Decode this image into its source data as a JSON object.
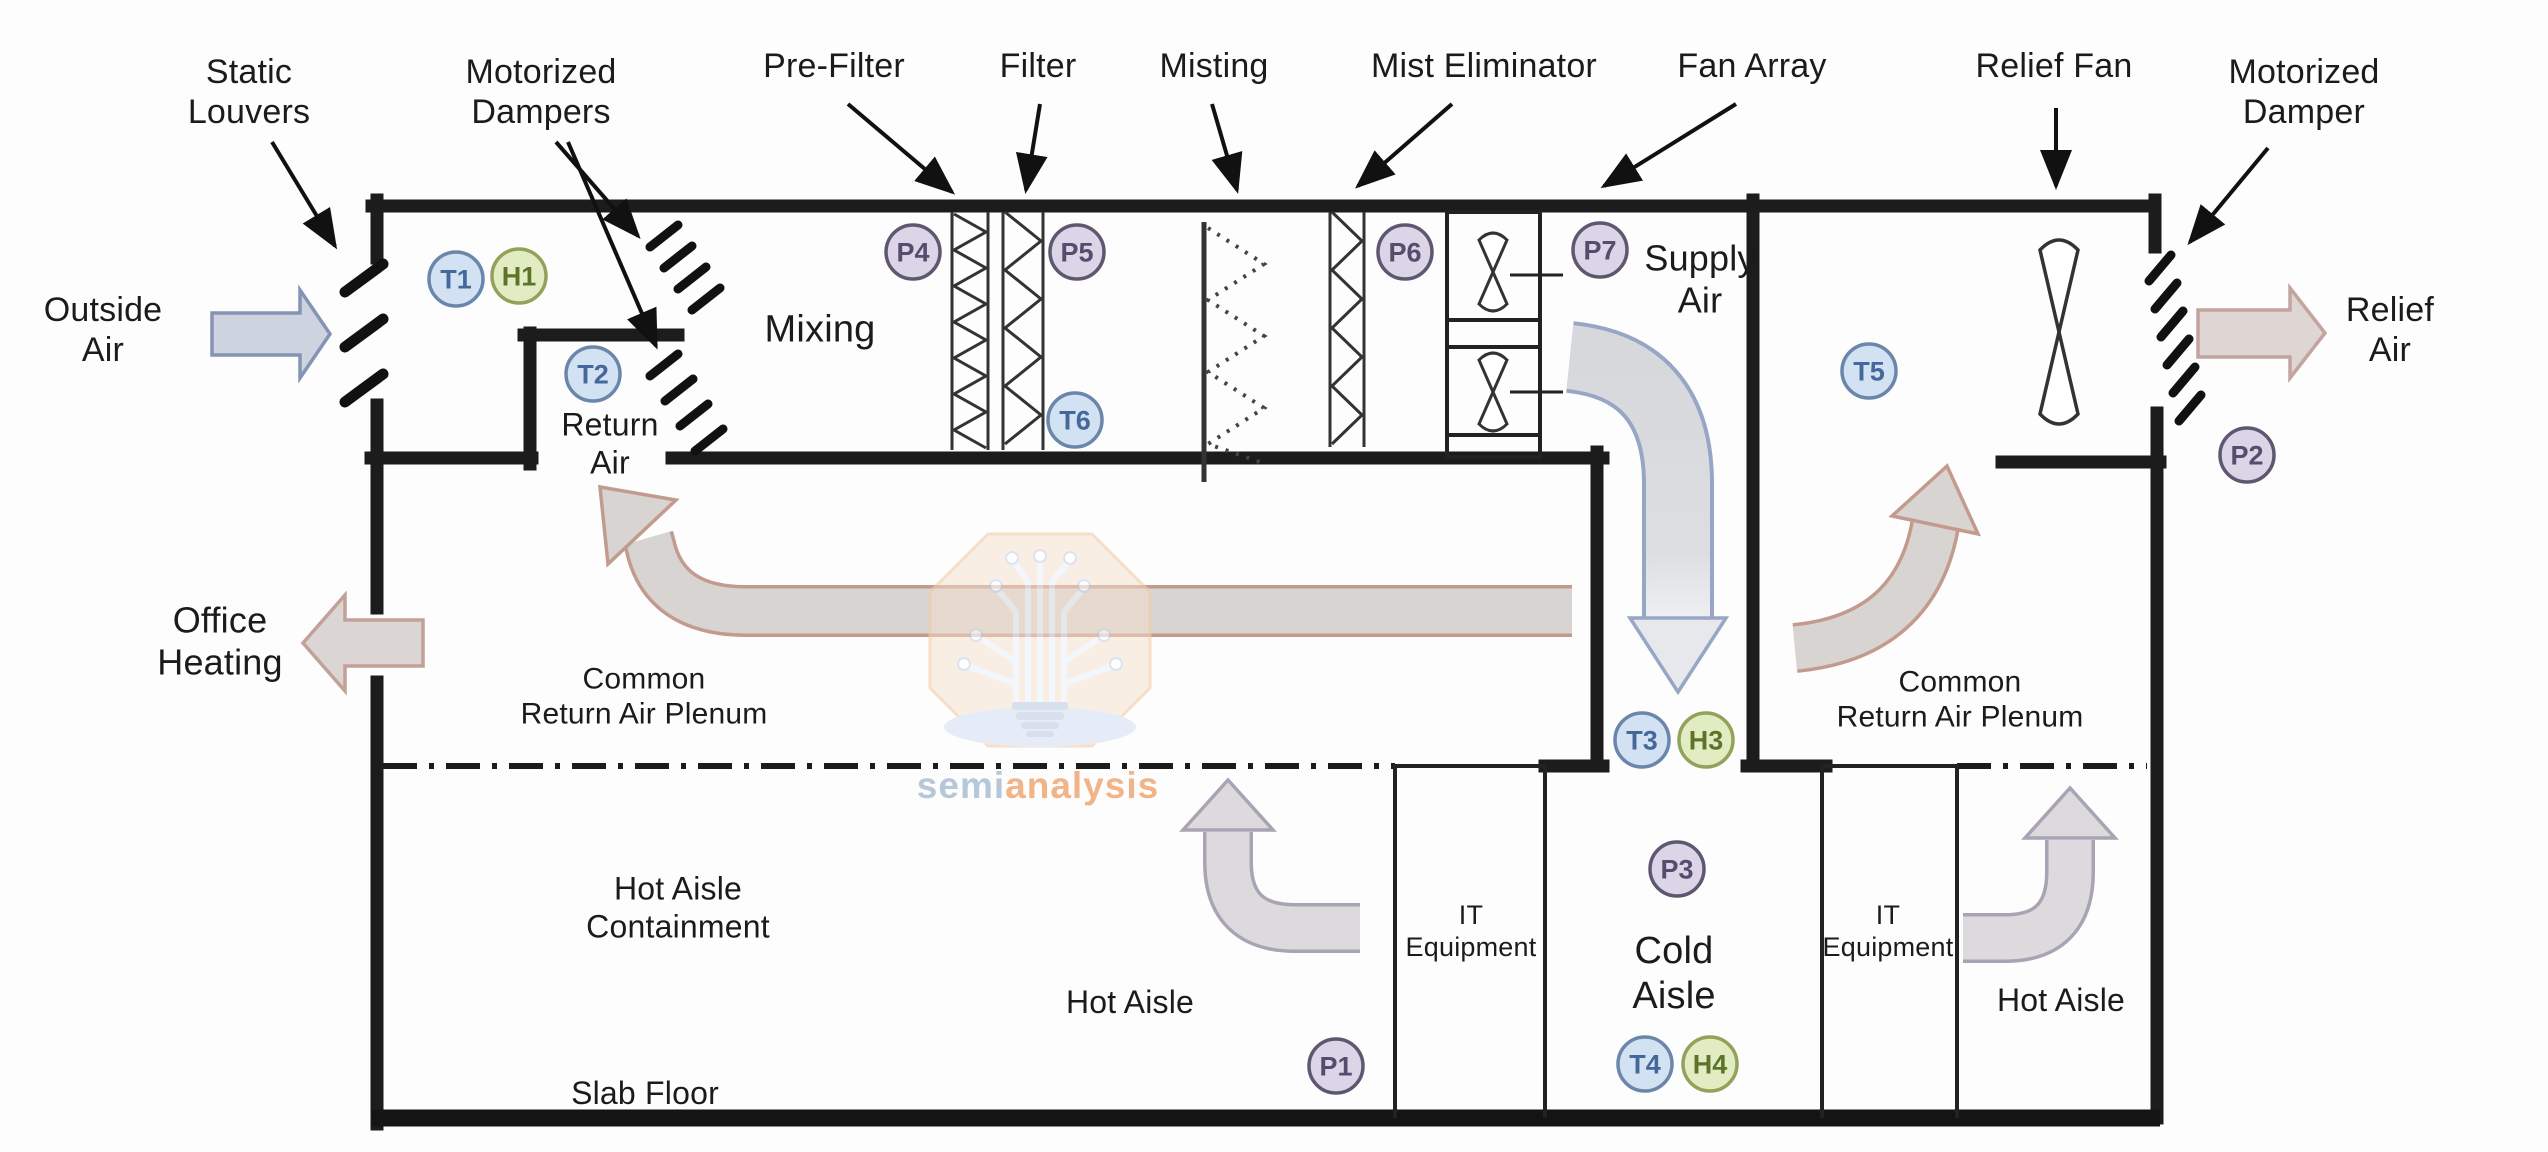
{
  "labels": {
    "static_louvers": "Static\nLouvers",
    "motorized_dampers": "Motorized\nDampers",
    "pre_filter": "Pre-Filter",
    "filter": "Filter",
    "misting": "Misting",
    "mist_eliminator": "Mist Eliminator",
    "fan_array": "Fan Array",
    "relief_fan": "Relief Fan",
    "motorized_damper": "Motorized\nDamper",
    "outside_air": "Outside\nAir",
    "relief_air": "Relief\nAir",
    "office_heating": "Office\nHeating",
    "mixing": "Mixing",
    "return_air": "Return\nAir",
    "supply_air": "Supply\nAir",
    "common_return_air_plenum_left": "Common\nReturn Air Plenum",
    "common_return_air_plenum_right": "Common\nReturn Air Plenum",
    "hot_aisle_containment": "Hot Aisle\nContainment",
    "hot_aisle_left": "Hot Aisle",
    "hot_aisle_right": "Hot Aisle",
    "slab_floor": "Slab Floor",
    "it_equipment_left": "IT\nEquipment",
    "it_equipment_right": "IT\nEquipment",
    "cold_aisle": "Cold\nAisle"
  },
  "sensors": [
    {
      "id": "T1",
      "kind": "T",
      "x": 456,
      "y": 279
    },
    {
      "id": "H1",
      "kind": "H",
      "x": 519,
      "y": 276
    },
    {
      "id": "T2",
      "kind": "T",
      "x": 593,
      "y": 374
    },
    {
      "id": "P4",
      "kind": "P",
      "x": 913,
      "y": 252
    },
    {
      "id": "P5",
      "kind": "P",
      "x": 1077,
      "y": 252
    },
    {
      "id": "T6",
      "kind": "T",
      "x": 1075,
      "y": 420
    },
    {
      "id": "P6",
      "kind": "P",
      "x": 1405,
      "y": 252
    },
    {
      "id": "P7",
      "kind": "P",
      "x": 1600,
      "y": 250
    },
    {
      "id": "T5",
      "kind": "T",
      "x": 1869,
      "y": 371
    },
    {
      "id": "P2",
      "kind": "P",
      "x": 2247,
      "y": 455
    },
    {
      "id": "T3",
      "kind": "T",
      "x": 1642,
      "y": 740
    },
    {
      "id": "H3",
      "kind": "H",
      "x": 1706,
      "y": 740
    },
    {
      "id": "P3",
      "kind": "P",
      "x": 1677,
      "y": 869
    },
    {
      "id": "T4",
      "kind": "T",
      "x": 1645,
      "y": 1064
    },
    {
      "id": "H4",
      "kind": "H",
      "x": 1710,
      "y": 1064
    },
    {
      "id": "P1",
      "kind": "P",
      "x": 1336,
      "y": 1066
    }
  ],
  "sensor_styles": {
    "T": {
      "fill": "#d3e2f2",
      "stroke": "#6b86ab",
      "text": "#44689b"
    },
    "H": {
      "fill": "#e2ecc3",
      "stroke": "#93a25a",
      "text": "#5c7429"
    },
    "P": {
      "fill": "#dcd5e8",
      "stroke": "#5d5870",
      "text": "#534d6e"
    }
  },
  "watermark": {
    "part1": "semi",
    "part2": "analysis"
  },
  "colors": {
    "wall": "#1c1c1c",
    "outside_air_arrow_fill": "#cdd4df",
    "outside_air_arrow_stroke": "#8593b4",
    "tan_arrow_fill": "#dbd6d3",
    "tan_arrow_stroke": "#c1a198",
    "supply_band_stroke": "#98a6c6",
    "hot_arrow_fill": "#dcdadd",
    "hot_arrow_stroke": "#a8a4b4",
    "return_band_edge": "#c29b8e",
    "watermark_peach": "#f6dfc9",
    "watermark_orange": "#f0a873",
    "watermark_blue": "#a9bed2"
  }
}
